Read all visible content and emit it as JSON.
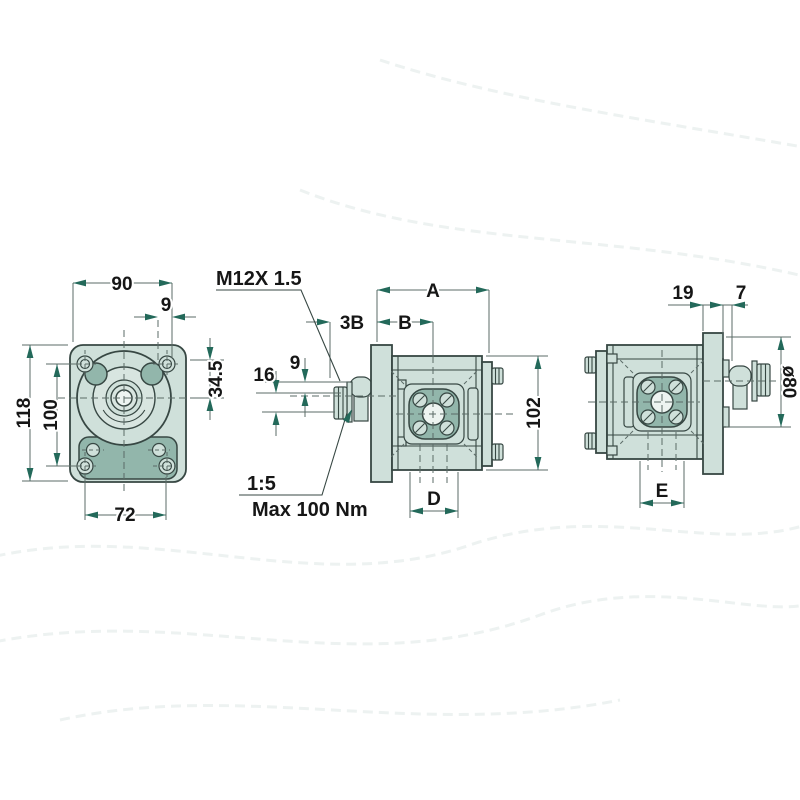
{
  "title": "hydraulic-gear-pump-dimension-drawing",
  "colors": {
    "background": "#ffffff",
    "part_fill": "#cfe0da",
    "part_dark_fill": "#92b6ab",
    "outline": "#374743",
    "dimension_line": "#5b6b67",
    "arrow": "#23695a",
    "text": "#161616"
  },
  "views": {
    "front": {
      "dims": {
        "top_width": "90",
        "pilot_offset": "9",
        "overall_height": "118",
        "bolt_spacing_vertical": "100",
        "center_height": "34.5",
        "bolt_spacing_horizontal": "72"
      }
    },
    "side": {
      "thread_label": "M12X 1.5",
      "taper_label": "1:5",
      "torque_label": "Max 100 Nm",
      "dims": {
        "shaft_length": "3B",
        "front_length": "B",
        "overall_length": "A",
        "shaft_step": "9",
        "shaft_dia": "16",
        "body_height": "102",
        "port_spacing": "D"
      }
    },
    "rear": {
      "dims": {
        "flange_thickness": "19",
        "pilot_depth": "7",
        "pilot_dia": "ø80",
        "port_spacing": "E"
      }
    }
  }
}
